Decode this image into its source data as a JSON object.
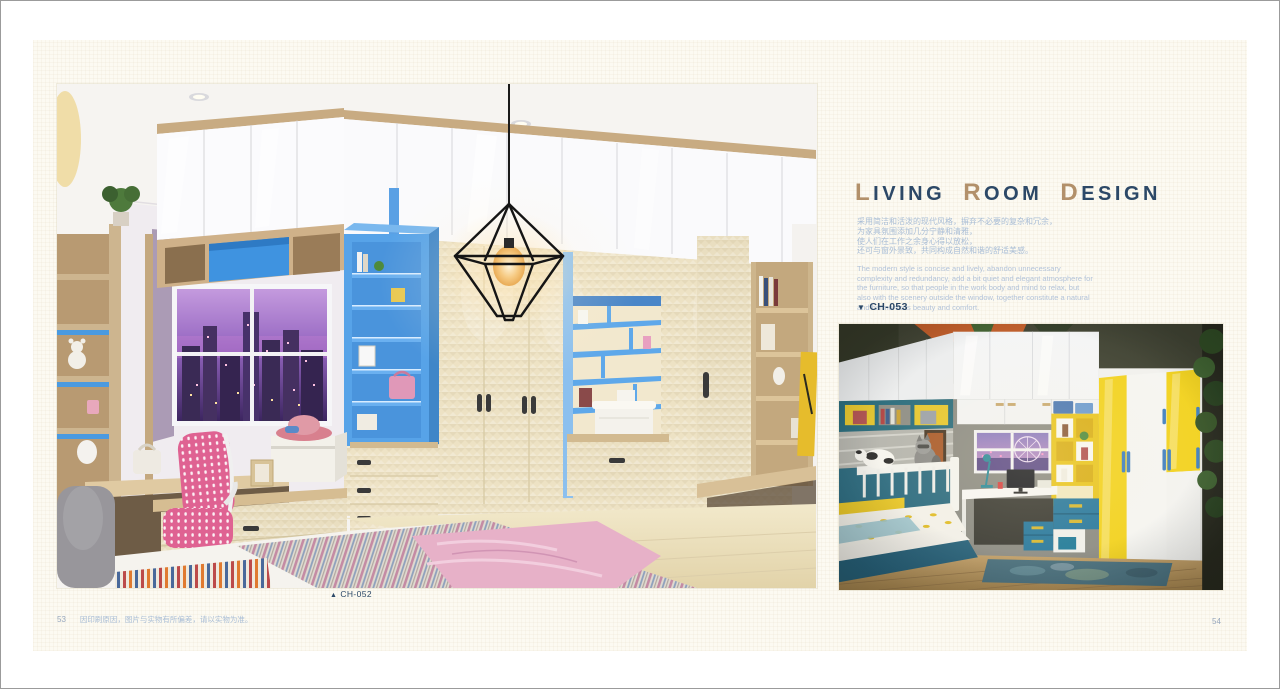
{
  "page": {
    "footer": {
      "left_page_number": "53",
      "disclaimer": "因印刷原因，图片与实物有所偏差，请以实物为准。",
      "right_page_number": "54"
    }
  },
  "left_photo": {
    "caption_marker": "▲",
    "caption_code": "CH-052"
  },
  "article": {
    "title": {
      "words": [
        {
          "initial": "L",
          "rest": "IVING"
        },
        {
          "initial": "R",
          "rest": "OOM"
        },
        {
          "initial": "D",
          "rest": "ESIGN"
        }
      ]
    },
    "intro_zh_lines": [
      "采用简洁和活泼的现代风格，摒弃不必要的复杂和冗余，",
      "为家具氛围添加几分宁静和清雅，",
      "使人们在工作之余身心得以放松，",
      "还可与窗外景致，共同构成自然和谐的舒适美感。"
    ],
    "intro_en": "The modern style is concise and lively, abandon unnecessary complexity and redundancy, add a bit quiet and elegant atmosphere for the furniture, so that people in the work body and mind to relax, but also with the scenery outside the window, together constitute a natural and harmonious beauty and comfort.",
    "photo_label_marker": "▼",
    "photo_label_code": "CH-053"
  },
  "colors": {
    "accent_navy": "#2c4867",
    "accent_tan": "#b2906a",
    "body_text_blue": "#a9bdd6",
    "page_background": "#fcfaf2",
    "blue_cabinet": "#57a3e8",
    "yellow_cabinet": "#f2d21e",
    "teal_cabinet": "#27789e"
  }
}
